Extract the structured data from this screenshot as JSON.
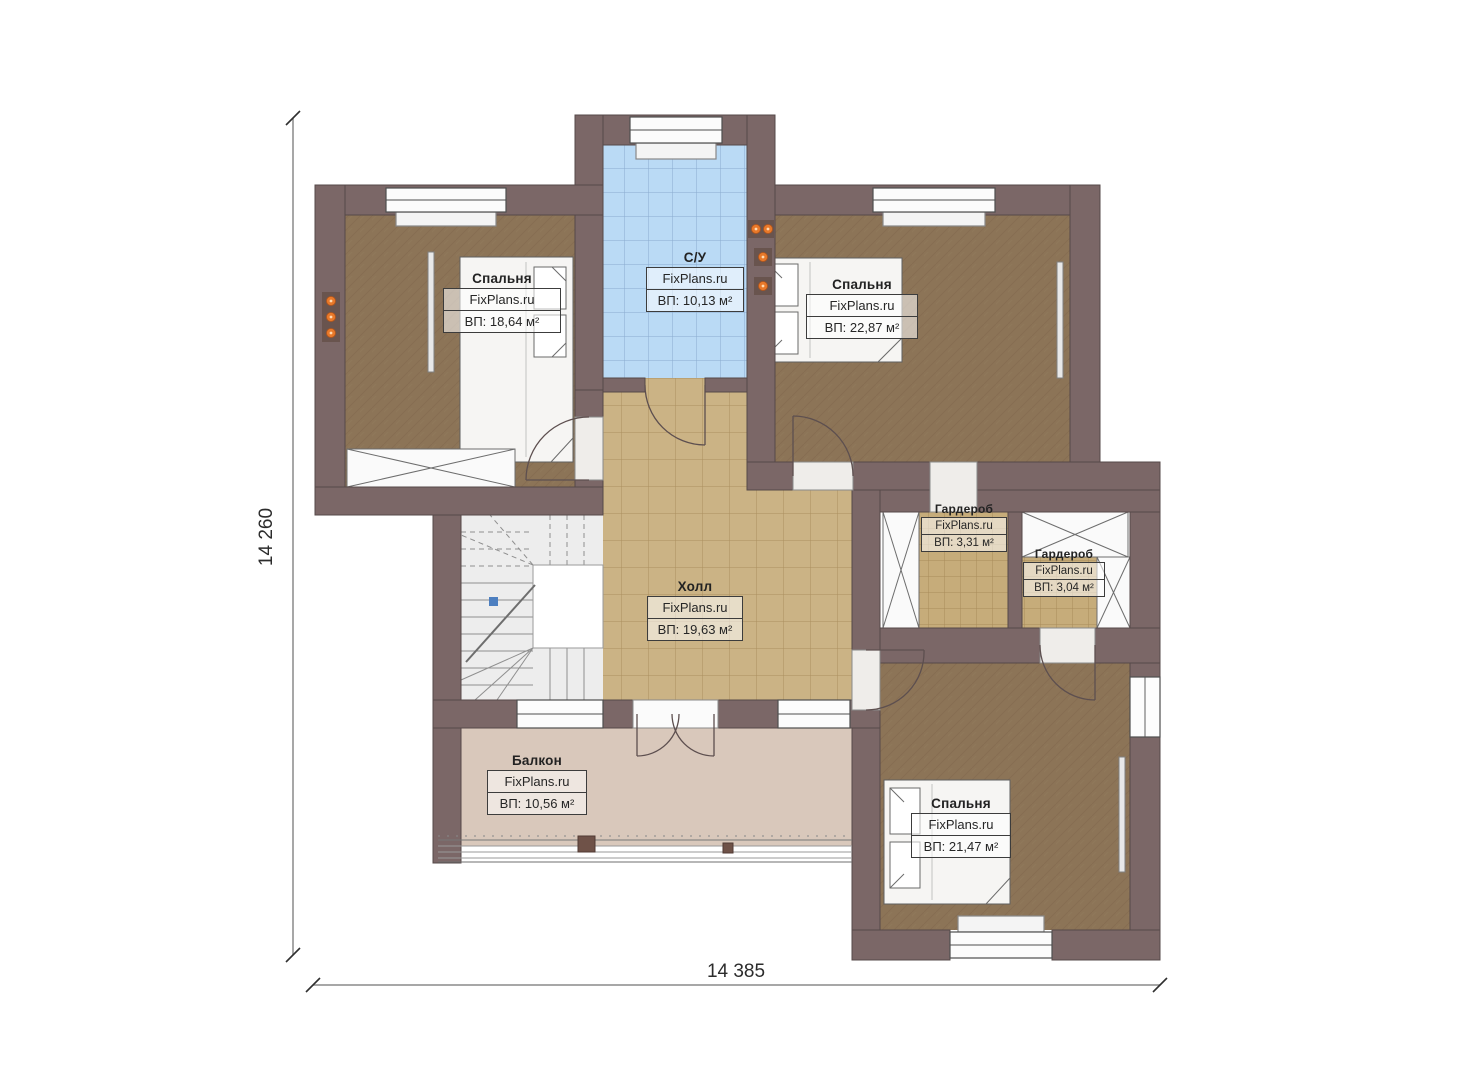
{
  "plan": {
    "dimensions": {
      "vertical_label": "14 260",
      "horizontal_label": "14 385"
    },
    "rooms": [
      {
        "id": "bedroom-1",
        "name": "Спальня",
        "brand": "FixPlans.ru",
        "area": "ВП: 18,64 м²"
      },
      {
        "id": "bathroom",
        "name": "С/У",
        "brand": "FixPlans.ru",
        "area": "ВП: 10,13 м²"
      },
      {
        "id": "bedroom-2",
        "name": "Спальня",
        "brand": "FixPlans.ru",
        "area": "ВП: 22,87 м²"
      },
      {
        "id": "wardrobe-1",
        "name": "Гардероб",
        "brand": "FixPlans.ru",
        "area": "ВП: 3,31 м²"
      },
      {
        "id": "wardrobe-2",
        "name": "Гардероб",
        "brand": "FixPlans.ru",
        "area": "ВП: 3,04 м²"
      },
      {
        "id": "hall",
        "name": "Холл",
        "brand": "FixPlans.ru",
        "area": "ВП: 19,63 м²"
      },
      {
        "id": "balcony",
        "name": "Балкон",
        "brand": "FixPlans.ru",
        "area": "ВП: 10,56 м²"
      },
      {
        "id": "bedroom-3",
        "name": "Спальня",
        "brand": "FixPlans.ru",
        "area": "ВП: 21,47 м²"
      }
    ],
    "colors": {
      "wall": "#7b6767",
      "bedroom_floor": "#8c7457",
      "hall_floor": "#cbb385",
      "bathroom_floor": "#badaf5",
      "wardrobe_floor": "#c6ac7a",
      "balcony_floor": "#d9c8bb",
      "stair_floor": "#ededed",
      "accent_orange": "#e8792a"
    }
  }
}
